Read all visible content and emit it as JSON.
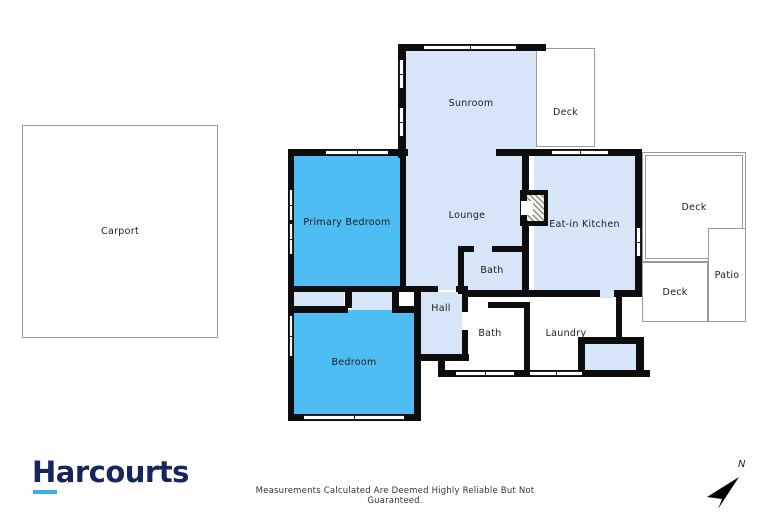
{
  "floor_plan": {
    "rooms": {
      "carport": {
        "label": "Carport"
      },
      "sunroom": {
        "label": "Sunroom"
      },
      "deck_top": {
        "label": "Deck"
      },
      "primary_bedroom": {
        "label": "Primary Bedroom"
      },
      "lounge": {
        "label": "Lounge"
      },
      "eat_in_kitchen": {
        "label": "Eat-in Kitchen"
      },
      "deck_right": {
        "label": "Deck"
      },
      "deck_lower": {
        "label": "Deck"
      },
      "patio": {
        "label": "Patio"
      },
      "bath_top": {
        "label": "Bath"
      },
      "hall": {
        "label": "Hall"
      },
      "bath_lower": {
        "label": "Bath"
      },
      "laundry": {
        "label": "Laundry"
      },
      "bedroom": {
        "label": "Bedroom"
      }
    },
    "colors": {
      "highlight_room": "#4DBDF4",
      "standard_room": "#D6E6F8",
      "wall": "#0d0d0d"
    }
  },
  "branding": {
    "logo_text": "Harcourts",
    "logo_color": "#16265C",
    "logo_underline_color": "#3BAFE0"
  },
  "footer": {
    "disclaimer": "Measurements Calculated Are Deemed Highly Reliable But Not Guaranteed."
  },
  "compass": {
    "label": "N"
  }
}
